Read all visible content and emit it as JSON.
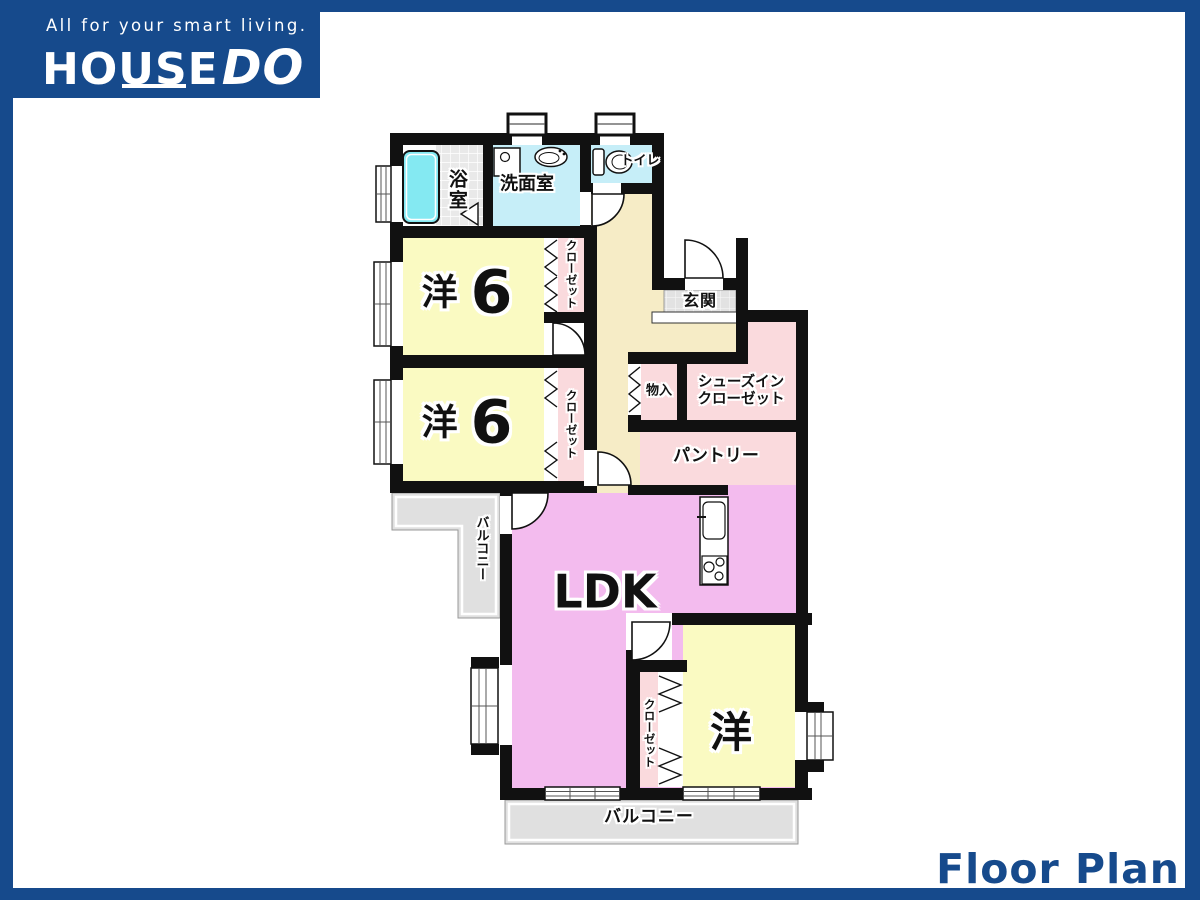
{
  "header": {
    "tagline": "All for your smart living.",
    "brand_primary": "HOUSE",
    "brand_accent": "DO"
  },
  "footer": {
    "title": "Floor Plan"
  },
  "plan": {
    "labels": {
      "bathroom": "浴室",
      "washroom": "洗面室",
      "toilet": "トイレ",
      "entrance": "玄関",
      "storage": "物入",
      "shoes_closet_line1": "シューズイン",
      "shoes_closet_line2": "クローゼット",
      "pantry": "パントリー",
      "closet": "クローゼット",
      "ldk": "LDK",
      "western_room_kanji": "洋",
      "western_room_size": "6",
      "western_room": "洋",
      "balcony": "バルコニー"
    },
    "colors": {
      "brand_blue": "#164a8c",
      "wall_black": "#111111",
      "room_yellow": "#fafac2",
      "closet_pink": "#fadadd",
      "ldk_pink": "#f3bbee",
      "hall_beige": "#f6ecc6",
      "water_cyan": "#c6eef8",
      "bathtub_cyan": "#84e9f2",
      "balcony_gray": "#e0e0e0",
      "entrance_tile_gray": "#e2e2e2"
    },
    "icons": {
      "bathtub": "bathtub-icon",
      "washing_machine": "washing-machine-icon",
      "sink": "sink-icon",
      "toilet": "toilet-icon",
      "kitchen_sink": "kitchen-sink-icon",
      "stove": "stove-icon",
      "door_swing": "door-arc-icon",
      "folding_closet_door": "zigzag-door-icon"
    }
  }
}
